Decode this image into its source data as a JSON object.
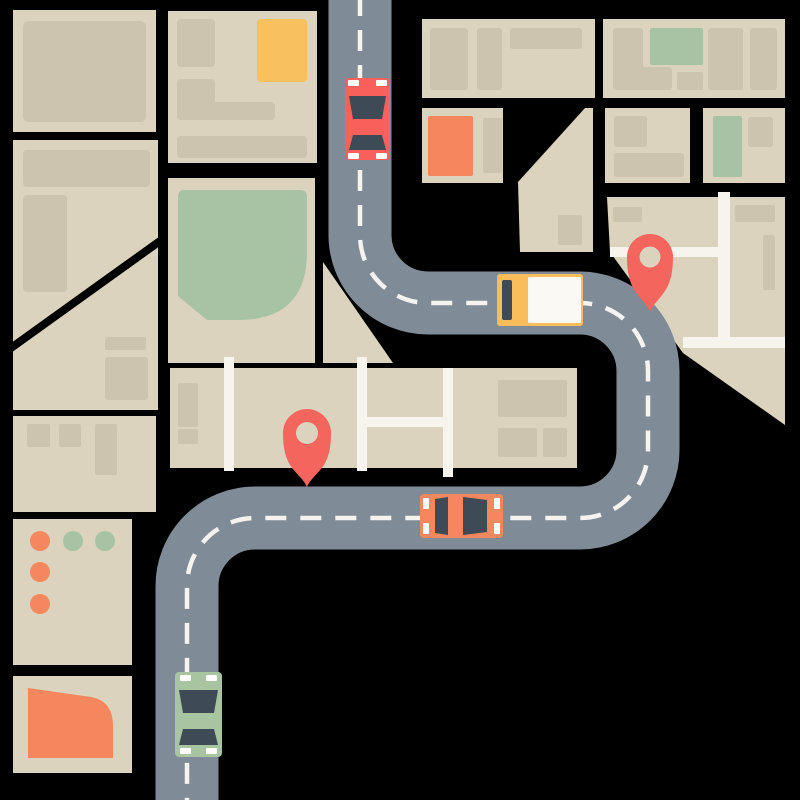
{
  "title": "Flat city map illustration with winding road, vehicles and location pins",
  "canvas": {
    "width": 800,
    "height": 800,
    "background": "#000000"
  },
  "palette": {
    "block": "#DBD3BE",
    "building": "#CCC4AE",
    "park_green": "#A7C3A3",
    "accent_yellow": "#F9C05E",
    "accent_orange": "#F5875F",
    "pin_red": "#F4655D",
    "road_gray": "#7F8B96",
    "lane_dash": "#F4F3F0",
    "street_white": "#F7F4EE",
    "vehicle_window": "#3E4A56",
    "car_red": "#F8605B",
    "car_green": "#A9C4A1",
    "truck_yellow": "#F9BE59",
    "truck_cargo": "#FBF9F3",
    "mark_white": "#FCFCFC",
    "cut_line": "#000000"
  },
  "city_blocks": [
    {
      "name": "block-left-1",
      "shape": "rect",
      "x": 13,
      "y": 10,
      "w": 143,
      "h": 122
    },
    {
      "name": "block-left-2",
      "shape": "rect",
      "x": 13,
      "y": 140,
      "w": 145,
      "h": 270
    },
    {
      "name": "block-left-3",
      "shape": "rect",
      "x": 13,
      "y": 416,
      "w": 143,
      "h": 96
    },
    {
      "name": "block-left-4-dots",
      "shape": "rect",
      "x": 13,
      "y": 519,
      "w": 119,
      "h": 146
    },
    {
      "name": "block-left-5-quarter",
      "shape": "rect",
      "x": 13,
      "y": 676,
      "w": 119,
      "h": 97
    },
    {
      "name": "block-mid-top",
      "shape": "rect",
      "x": 168,
      "y": 11,
      "w": 149,
      "h": 152
    },
    {
      "name": "block-mid-park",
      "shape": "rect",
      "x": 168,
      "y": 178,
      "w": 147,
      "h": 185
    },
    {
      "name": "block-central-strip",
      "shape": "rect",
      "x": 170,
      "y": 368,
      "w": 407,
      "h": 100
    },
    {
      "name": "block-corner-triangle",
      "shape": "polygon",
      "points": "323,262 393,363 323,363"
    },
    {
      "name": "block-top-right-1",
      "shape": "rect",
      "x": 422,
      "y": 19,
      "w": 173,
      "h": 79
    },
    {
      "name": "block-top-right-2",
      "shape": "rect",
      "x": 603,
      "y": 19,
      "w": 182,
      "h": 79
    },
    {
      "name": "block-orange-row",
      "shape": "rect",
      "x": 422,
      "y": 108,
      "w": 81,
      "h": 75
    },
    {
      "name": "block-wedge",
      "shape": "polygon",
      "points": "585,108 593,108 593,252 520,252 518,182"
    },
    {
      "name": "block-right-row-1",
      "shape": "rect",
      "x": 605,
      "y": 108,
      "w": 85,
      "h": 75
    },
    {
      "name": "block-right-row-2",
      "shape": "rect",
      "x": 703,
      "y": 108,
      "w": 82,
      "h": 75
    },
    {
      "name": "block-pin-grid",
      "shape": "polygon",
      "points": "607,197 785,197 785,425 683,353 610,252"
    }
  ],
  "block_cut_lines": [
    {
      "name": "diagonal-street-cut",
      "x1": 4,
      "y1": 353,
      "x2": 160,
      "y2": 241,
      "width": 8
    }
  ],
  "buildings": [
    {
      "x": 23,
      "y": 21,
      "w": 123,
      "h": 101,
      "rx": 6
    },
    {
      "x": 23,
      "y": 150,
      "w": 127,
      "h": 37,
      "rx": 4
    },
    {
      "x": 23,
      "y": 195,
      "w": 44,
      "h": 97,
      "rx": 4
    },
    {
      "x": 105,
      "y": 337,
      "w": 41,
      "h": 13,
      "rx": 2
    },
    {
      "x": 105,
      "y": 357,
      "w": 43,
      "h": 43,
      "rx": 3
    },
    {
      "x": 27,
      "y": 424,
      "w": 23,
      "h": 23,
      "rx": 2
    },
    {
      "x": 59,
      "y": 424,
      "w": 22,
      "h": 23,
      "rx": 2
    },
    {
      "x": 95,
      "y": 424,
      "w": 22,
      "h": 51,
      "rx": 2
    },
    {
      "x": 177,
      "y": 19,
      "w": 38,
      "h": 48,
      "rx": 4
    },
    {
      "x": 177,
      "y": 79,
      "w": 38,
      "h": 41,
      "rx": 4
    },
    {
      "x": 177,
      "y": 102,
      "w": 98,
      "h": 18,
      "rx": 4
    },
    {
      "x": 177,
      "y": 136,
      "w": 130,
      "h": 22,
      "rx": 4
    },
    {
      "x": 178,
      "y": 383,
      "w": 20,
      "h": 44,
      "rx": 2
    },
    {
      "x": 178,
      "y": 429,
      "w": 20,
      "h": 15,
      "rx": 2
    },
    {
      "x": 498,
      "y": 380,
      "w": 69,
      "h": 37,
      "rx": 2
    },
    {
      "x": 498,
      "y": 428,
      "w": 39,
      "h": 29,
      "rx": 2
    },
    {
      "x": 543,
      "y": 428,
      "w": 24,
      "h": 29,
      "rx": 2
    },
    {
      "x": 430,
      "y": 28,
      "w": 38,
      "h": 62,
      "rx": 3
    },
    {
      "x": 477,
      "y": 28,
      "w": 25,
      "h": 62,
      "rx": 3
    },
    {
      "x": 510,
      "y": 28,
      "w": 72,
      "h": 21,
      "rx": 3
    },
    {
      "x": 613,
      "y": 28,
      "w": 30,
      "h": 62,
      "rx": 3
    },
    {
      "x": 613,
      "y": 67,
      "w": 59,
      "h": 23,
      "rx": 3
    },
    {
      "x": 677,
      "y": 72,
      "w": 26,
      "h": 18,
      "rx": 2
    },
    {
      "x": 708,
      "y": 28,
      "w": 35,
      "h": 62,
      "rx": 3
    },
    {
      "x": 750,
      "y": 28,
      "w": 27,
      "h": 62,
      "rx": 3
    },
    {
      "x": 483,
      "y": 118,
      "w": 19,
      "h": 55,
      "rx": 2
    },
    {
      "x": 558,
      "y": 215,
      "w": 24,
      "h": 30,
      "rx": 2
    },
    {
      "x": 614,
      "y": 116,
      "w": 33,
      "h": 31,
      "rx": 3
    },
    {
      "x": 614,
      "y": 153,
      "w": 70,
      "h": 24,
      "rx": 3
    },
    {
      "x": 748,
      "y": 117,
      "w": 25,
      "h": 30,
      "rx": 3
    },
    {
      "x": 613,
      "y": 207,
      "w": 29,
      "h": 15,
      "rx": 2
    },
    {
      "x": 735,
      "y": 205,
      "w": 40,
      "h": 17,
      "rx": 2
    },
    {
      "x": 763,
      "y": 235,
      "w": 12,
      "h": 55,
      "rx": 2
    }
  ],
  "features": [
    {
      "name": "park-green",
      "kind": "path",
      "color": "park_green",
      "d": "M184,190 L300,190 Q307,190 307,197 L307,252 Q307,320 238,320 L207,320 L178,296 L178,197 Q178,190 184,190 Z"
    },
    {
      "name": "green-building-top-right",
      "kind": "rect",
      "color": "park_green",
      "x": 650,
      "y": 28,
      "w": 53,
      "h": 37,
      "rx": 2
    },
    {
      "name": "green-building-mid-right",
      "kind": "rect",
      "color": "park_green",
      "x": 713,
      "y": 116,
      "w": 29,
      "h": 61,
      "rx": 2
    },
    {
      "name": "yellow-building",
      "kind": "rect",
      "color": "accent_yellow",
      "x": 257,
      "y": 19,
      "w": 50,
      "h": 63,
      "rx": 4
    },
    {
      "name": "orange-building",
      "kind": "rect",
      "color": "accent_orange",
      "x": 428,
      "y": 116,
      "w": 45,
      "h": 60,
      "rx": 2
    },
    {
      "name": "orange-quarter-shape",
      "kind": "path",
      "color": "accent_orange",
      "d": "M28,688 L91,697 Q113,701 113,726 L113,758 L28,758 Z"
    },
    {
      "name": "dot-orange-1",
      "kind": "circle",
      "color": "accent_orange",
      "cx": 40,
      "cy": 541,
      "r": 10
    },
    {
      "name": "dot-green-1",
      "kind": "circle",
      "color": "park_green",
      "cx": 73,
      "cy": 541,
      "r": 10
    },
    {
      "name": "dot-green-2",
      "kind": "circle",
      "color": "park_green",
      "cx": 105,
      "cy": 541,
      "r": 10
    },
    {
      "name": "dot-orange-2",
      "kind": "circle",
      "color": "accent_orange",
      "cx": 40,
      "cy": 572,
      "r": 10
    },
    {
      "name": "dot-orange-3",
      "kind": "circle",
      "color": "accent_orange",
      "cx": 40,
      "cy": 604,
      "r": 10
    }
  ],
  "streets": [
    {
      "name": "street-strip-left",
      "x": 224,
      "y": 357,
      "w": 10,
      "h": 114
    },
    {
      "name": "street-strip-mid",
      "x": 357,
      "y": 357,
      "w": 10,
      "h": 114
    },
    {
      "name": "street-strip-right",
      "x": 443,
      "y": 368,
      "w": 10,
      "h": 109
    },
    {
      "name": "street-strip-cross",
      "x": 367,
      "y": 417,
      "w": 78,
      "h": 10
    },
    {
      "name": "street-grid-vertical",
      "x": 718,
      "y": 192,
      "w": 12,
      "h": 156
    },
    {
      "name": "street-grid-cross-upper",
      "x": 610,
      "y": 247,
      "w": 108,
      "h": 10
    },
    {
      "name": "street-grid-cross-lower",
      "x": 683,
      "y": 337,
      "w": 102,
      "h": 11
    }
  ],
  "road": {
    "centerline": "M360,-5 L360,235 A68,68 0 0 0 428,303 L580,303 A68,68 0 0 1 648,371 L648,450 A68,68 0 0 1 580,518 L255,518 A68,68 0 0 0 187,586 L187,805",
    "width": 63,
    "dash_width": 4.5,
    "dash_pattern": "21 14"
  },
  "vehicles": [
    {
      "name": "car-red",
      "parts": [
        {
          "kind": "rect",
          "color": "car_red",
          "x": 345,
          "y": 78,
          "w": 45,
          "h": 82,
          "rx": 4
        },
        {
          "kind": "polygon",
          "color": "vehicle_window",
          "points": "349,96 386,96 382,119 353,119"
        },
        {
          "kind": "polygon",
          "color": "vehicle_window",
          "points": "353,135 382,135 386,150 349,150"
        },
        {
          "kind": "rect",
          "color": "mark_white",
          "x": 348,
          "y": 80,
          "w": 11,
          "h": 6,
          "rx": 1
        },
        {
          "kind": "rect",
          "color": "mark_white",
          "x": 376,
          "y": 80,
          "w": 11,
          "h": 6,
          "rx": 1
        },
        {
          "kind": "rect",
          "color": "mark_white",
          "x": 348,
          "y": 153,
          "w": 11,
          "h": 6,
          "rx": 1
        },
        {
          "kind": "rect",
          "color": "mark_white",
          "x": 376,
          "y": 153,
          "w": 11,
          "h": 6,
          "rx": 1
        }
      ]
    },
    {
      "name": "delivery-truck",
      "parts": [
        {
          "kind": "rect",
          "color": "truck_yellow",
          "x": 497,
          "y": 274,
          "w": 86,
          "h": 52,
          "rx": 3
        },
        {
          "kind": "rect",
          "color": "truck_cargo",
          "x": 528,
          "y": 277,
          "w": 53,
          "h": 46,
          "rx": 1
        },
        {
          "kind": "rect",
          "color": "vehicle_window",
          "x": 502,
          "y": 280,
          "w": 10,
          "h": 40,
          "rx": 2
        }
      ]
    },
    {
      "name": "car-orange",
      "parts": [
        {
          "kind": "rect",
          "color": "accent_orange",
          "x": 420,
          "y": 494,
          "w": 83,
          "h": 44,
          "rx": 4
        },
        {
          "kind": "polygon",
          "color": "vehicle_window",
          "points": "435,499 448,497 448,535 435,533"
        },
        {
          "kind": "polygon",
          "color": "vehicle_window",
          "points": "463,497 487,500 487,532 463,535"
        },
        {
          "kind": "rect",
          "color": "mark_white",
          "x": 423,
          "y": 498,
          "w": 6,
          "h": 11,
          "rx": 1
        },
        {
          "kind": "rect",
          "color": "mark_white",
          "x": 423,
          "y": 523,
          "w": 6,
          "h": 11,
          "rx": 1
        },
        {
          "kind": "rect",
          "color": "mark_white",
          "x": 494,
          "y": 498,
          "w": 6,
          "h": 11,
          "rx": 1
        },
        {
          "kind": "rect",
          "color": "mark_white",
          "x": 494,
          "y": 523,
          "w": 6,
          "h": 11,
          "rx": 1
        }
      ]
    },
    {
      "name": "car-green",
      "parts": [
        {
          "kind": "rect",
          "color": "car_green",
          "x": 175,
          "y": 672,
          "w": 47,
          "h": 85,
          "rx": 4
        },
        {
          "kind": "polygon",
          "color": "vehicle_window",
          "points": "179,690 218,690 214,713 183,713"
        },
        {
          "kind": "polygon",
          "color": "vehicle_window",
          "points": "183,729 214,729 218,745 179,745"
        },
        {
          "kind": "rect",
          "color": "mark_white",
          "x": 180,
          "y": 675,
          "w": 11,
          "h": 6,
          "rx": 1
        },
        {
          "kind": "rect",
          "color": "mark_white",
          "x": 206,
          "y": 675,
          "w": 11,
          "h": 6,
          "rx": 1
        },
        {
          "kind": "rect",
          "color": "mark_white",
          "x": 180,
          "y": 748,
          "w": 11,
          "h": 6,
          "rx": 1
        },
        {
          "kind": "rect",
          "color": "mark_white",
          "x": 206,
          "y": 748,
          "w": 11,
          "h": 6,
          "rx": 1
        }
      ]
    }
  ],
  "pins": [
    {
      "name": "map-pin-north",
      "cx": 650,
      "cy": 257,
      "r": 23,
      "hole_r": 10.5,
      "tip_y": 312
    },
    {
      "name": "map-pin-south",
      "cx": 307,
      "cy": 433,
      "r": 24,
      "hole_r": 11,
      "tip_y": 487
    }
  ]
}
